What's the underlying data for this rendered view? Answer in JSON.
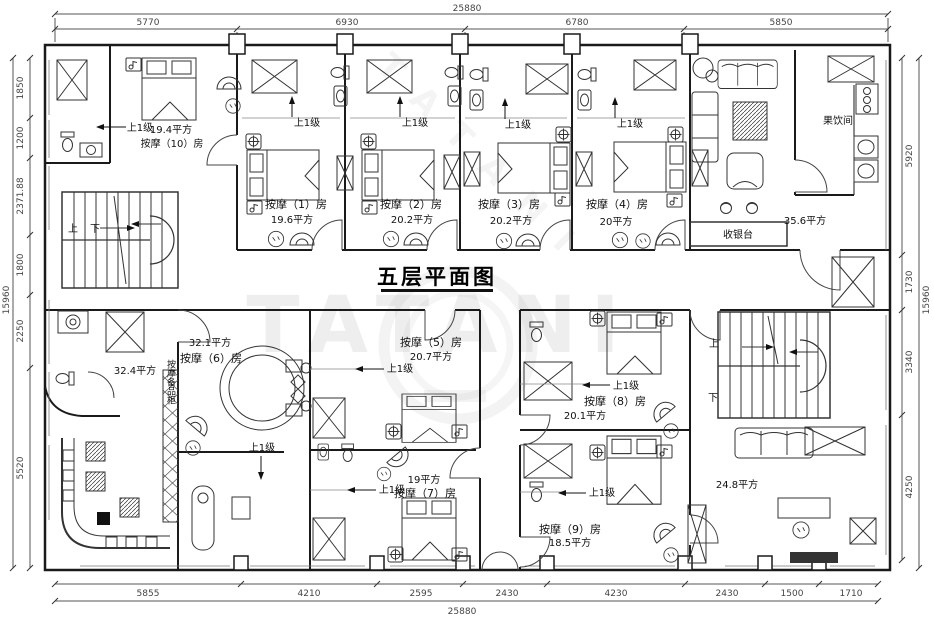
{
  "title": "五层平面图",
  "watermark": "TATANI",
  "dimensions": {
    "top_overall": "25880",
    "top": [
      "5770",
      "6930",
      "6780",
      "5850"
    ],
    "bottom": [
      "5855",
      "4210",
      "2595",
      "2430",
      "4230",
      "2430",
      "1500",
      "1710"
    ],
    "bottom_overall": "25880",
    "left_overall": "15960",
    "left": [
      "1850",
      "1200",
      "2371.88",
      "1800",
      "2250",
      "5520"
    ],
    "right_overall": "15960",
    "right": [
      "5920",
      "1730",
      "3340",
      "4250"
    ]
  },
  "rooms": {
    "room10": {
      "name": "按摩（10）房",
      "area": "19.4平方"
    },
    "room1": {
      "name": "按摩（1）房",
      "area": "19.6平方"
    },
    "room2": {
      "name": "按摩（2）房",
      "area": "20.2平方"
    },
    "room3": {
      "name": "按摩（3）房",
      "area": "20.2平方"
    },
    "room4": {
      "name": "按摩（4）房",
      "area": "20平方"
    },
    "room5": {
      "name": "按摩（5）房",
      "area": "20.7平方"
    },
    "room6": {
      "name": "按摩（6）房",
      "area": "32.1平方"
    },
    "room7": {
      "name": "按摩（7）房",
      "area": "19平方"
    },
    "room8": {
      "name": "按摩（8）房",
      "area": "20.1平方"
    },
    "room9": {
      "name": "按摩（9）房",
      "area": "18.5平方"
    },
    "lounge_area": "35.6平方",
    "hall_area": "32.4平方",
    "rest_area": "24.8平方",
    "fruit_room": "果饮间",
    "cashier": "收银台"
  },
  "labels": {
    "step_up_one": "上1级",
    "up": "上",
    "down": "下",
    "cabinet": "按摩备品柜"
  }
}
